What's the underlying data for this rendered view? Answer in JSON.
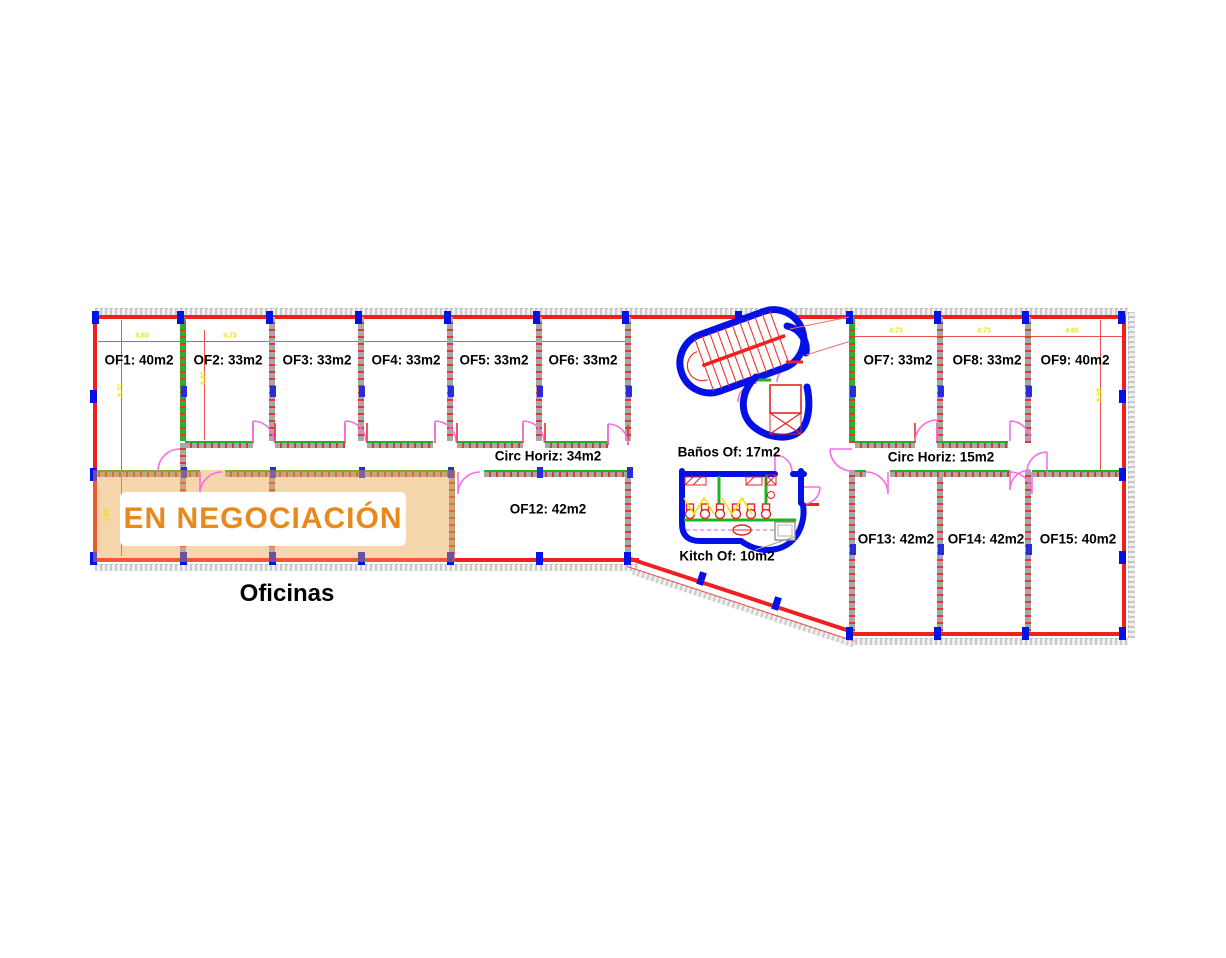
{
  "banner": {
    "text": "EN NEGOCIACIÓN",
    "color": "#e8891b"
  },
  "plan_title": "Oficinas",
  "rooms": [
    {
      "id": "OF1",
      "label": "OF1: 40m2"
    },
    {
      "id": "OF2",
      "label": "OF2: 33m2"
    },
    {
      "id": "OF3",
      "label": "OF3: 33m2"
    },
    {
      "id": "OF4",
      "label": "OF4: 33m2"
    },
    {
      "id": "OF5",
      "label": "OF5: 33m2"
    },
    {
      "id": "OF6",
      "label": "OF6: 33m2"
    },
    {
      "id": "OF7",
      "label": "OF7: 33m2"
    },
    {
      "id": "OF8",
      "label": "OF8: 33m2"
    },
    {
      "id": "OF9",
      "label": "OF9: 40m2"
    },
    {
      "id": "OF12",
      "label": "OF12: 42m2"
    },
    {
      "id": "OF13",
      "label": "OF13: 42m2"
    },
    {
      "id": "OF14",
      "label": "OF14: 42m2"
    },
    {
      "id": "OF15",
      "label": "OF15: 40m2"
    }
  ],
  "areas": {
    "circulation_left": "Circ Horiz: 34m2",
    "circulation_right": "Circ Horiz: 15m2",
    "bathrooms": "Baños Of: 17m2",
    "kitchen": "Kitch Of: 10m2"
  },
  "dims": {
    "top_left": [
      "4.60",
      "4.73"
    ],
    "top_right": [
      "4.73",
      "4.73",
      "4.60"
    ],
    "vertical": [
      "8.71",
      "6.91",
      "8.58",
      "3.95"
    ]
  },
  "colors": {
    "wall_red": "#f02020",
    "column_blue": "#0310e6",
    "wall_green": "#1fb41f",
    "door_magenta": "#f46fe3",
    "dim_yellow": "#f2e000",
    "highlight_orange": "rgba(236,164,70,0.45)"
  }
}
